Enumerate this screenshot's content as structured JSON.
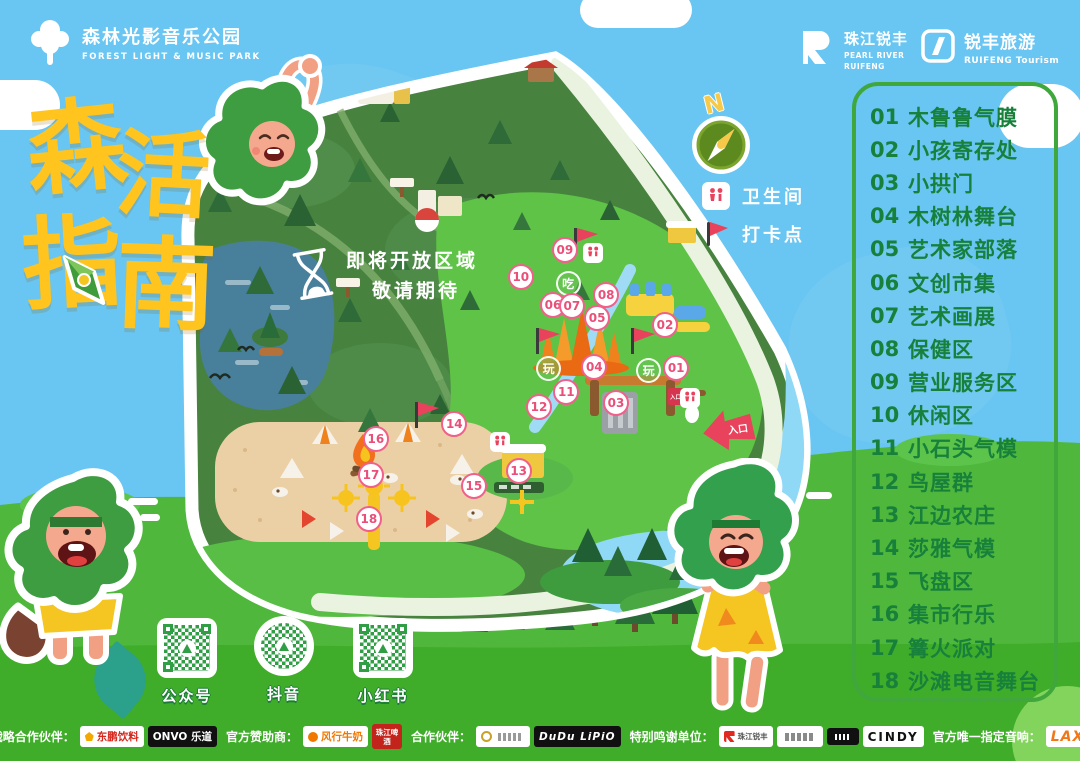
{
  "palette": {
    "sky": "#69C5F1",
    "grass": "#4FB83C",
    "grass_dark": "#3FAD2A",
    "forest": "#47823F",
    "meadow": "#5FC347",
    "sand": "#ECD0A5",
    "lake": "#48809B",
    "river": "#8FD8F6",
    "title_yellow": "#FFC41E",
    "legend_green": "#17803B",
    "marker_pink": "#EF6180",
    "flag_red": "#E8425C",
    "qr_green": "#2F9E44"
  },
  "header": {
    "park_logo": {
      "zh": "森林光影音乐公园",
      "en": "FOREST LIGHT & MUSIC PARK"
    },
    "brand1": {
      "zh": "珠江锐丰",
      "en": "PEARL RIVER\nRUIFENG"
    },
    "brand2": {
      "zh": "锐丰旅游",
      "en": "RUIFENG Tourism"
    }
  },
  "title": {
    "chars": [
      {
        "ch": "森",
        "cls": "t1"
      },
      {
        "ch": "活",
        "cls": "t2"
      },
      {
        "ch": "指",
        "cls": "t3"
      },
      {
        "ch": "南",
        "cls": "t4"
      }
    ]
  },
  "compass": {
    "north": "N"
  },
  "map_key": {
    "toilet": "卫生间",
    "checkin": "打卡点"
  },
  "map": {
    "coming_soon_line1": "即将开放区域",
    "coming_soon_line2": "敬请期待",
    "entrance_arrow_label": "入口",
    "entrance_sign_label": "入口"
  },
  "legend": {
    "items": [
      {
        "num": "01",
        "name": "木鲁鲁气膜"
      },
      {
        "num": "02",
        "name": "小孩寄存处"
      },
      {
        "num": "03",
        "name": "小拱门"
      },
      {
        "num": "04",
        "name": "木树林舞台"
      },
      {
        "num": "05",
        "name": "艺术家部落"
      },
      {
        "num": "06",
        "name": "文创市集"
      },
      {
        "num": "07",
        "name": "艺术画展"
      },
      {
        "num": "08",
        "name": "保健区"
      },
      {
        "num": "09",
        "name": "营业服务区"
      },
      {
        "num": "10",
        "name": "休闲区"
      },
      {
        "num": "11",
        "name": "小石头气模"
      },
      {
        "num": "12",
        "name": "鸟屋群"
      },
      {
        "num": "13",
        "name": "江边农庄"
      },
      {
        "num": "14",
        "name": "莎雅气模"
      },
      {
        "num": "15",
        "name": "飞盘区"
      },
      {
        "num": "16",
        "name": "集市行乐"
      },
      {
        "num": "17",
        "name": "篝火派对"
      },
      {
        "num": "18",
        "name": "沙滩电音舞台"
      }
    ]
  },
  "markers": [
    {
      "num": "01",
      "x": 76.6,
      "y": 51.3
    },
    {
      "num": "02",
      "x": 75.0,
      "y": 44.4
    },
    {
      "num": "03",
      "x": 68.0,
      "y": 56.9
    },
    {
      "num": "04",
      "x": 64.9,
      "y": 51.1
    },
    {
      "num": "05",
      "x": 65.3,
      "y": 43.2
    },
    {
      "num": "06",
      "x": 59.0,
      "y": 41.1
    },
    {
      "num": "07",
      "x": 61.7,
      "y": 41.3
    },
    {
      "num": "08",
      "x": 66.6,
      "y": 39.5
    },
    {
      "num": "09",
      "x": 60.7,
      "y": 32.3
    },
    {
      "num": "10",
      "x": 54.4,
      "y": 36.6
    },
    {
      "num": "11",
      "x": 60.9,
      "y": 55.2
    },
    {
      "num": "12",
      "x": 57.0,
      "y": 57.6
    },
    {
      "num": "13",
      "x": 54.1,
      "y": 67.9
    },
    {
      "num": "14",
      "x": 44.9,
      "y": 60.3
    },
    {
      "num": "15",
      "x": 47.7,
      "y": 70.3
    },
    {
      "num": "16",
      "x": 33.7,
      "y": 62.7
    },
    {
      "num": "17",
      "x": 33.0,
      "y": 68.5
    },
    {
      "num": "18",
      "x": 32.7,
      "y": 75.6
    }
  ],
  "badges": [
    {
      "label": "吃",
      "x": 61.1,
      "y": 37.6
    },
    {
      "label": "玩",
      "x": 58.3,
      "y": 51.3
    },
    {
      "label": "玩",
      "x": 72.6,
      "y": 51.6
    }
  ],
  "toilet_spots": [
    {
      "x": 64.7,
      "y": 32.7
    },
    {
      "x": 78.6,
      "y": 56.1
    },
    {
      "x": 51.4,
      "y": 63.2
    }
  ],
  "qr": {
    "items": [
      {
        "label": "公众号",
        "cls": "q1"
      },
      {
        "label": "抖音",
        "cls": "q2"
      },
      {
        "label": "小红书",
        "cls": "q3"
      }
    ]
  },
  "sponsors": {
    "segments": [
      {
        "label": "战略合作伙伴：",
        "logos": [
          {
            "text": "东鹏饮料",
            "cls": "lg-dongpeng"
          },
          {
            "text": "ONVO 乐道",
            "cls": "lg-onvo"
          }
        ]
      },
      {
        "label": "官方赞助商：",
        "logos": [
          {
            "text": "风行牛奶",
            "cls": "lg-fengxing"
          },
          {
            "text": "珠江啤酒",
            "cls": "lg-zhujiang"
          }
        ]
      },
      {
        "label": "合作伙伴：",
        "logos": [
          {
            "text": "",
            "cls": "lg-emblem"
          },
          {
            "text": "DuDu LiPiO",
            "cls": "lg-dudu"
          }
        ]
      },
      {
        "label": "特别鸣谢单位：",
        "logos": [
          {
            "text": "珠江锐丰",
            "cls": "lg-rf"
          },
          {
            "text": "",
            "cls": "lg-plain"
          },
          {
            "text": "",
            "cls": "lg-blacksm"
          },
          {
            "text": "CINDY",
            "cls": "lg-cindy"
          }
        ]
      },
      {
        "label": "官方唯一指定音响：",
        "logos": [
          {
            "text": "LAX",
            "cls": "lg-lax"
          }
        ]
      }
    ]
  }
}
